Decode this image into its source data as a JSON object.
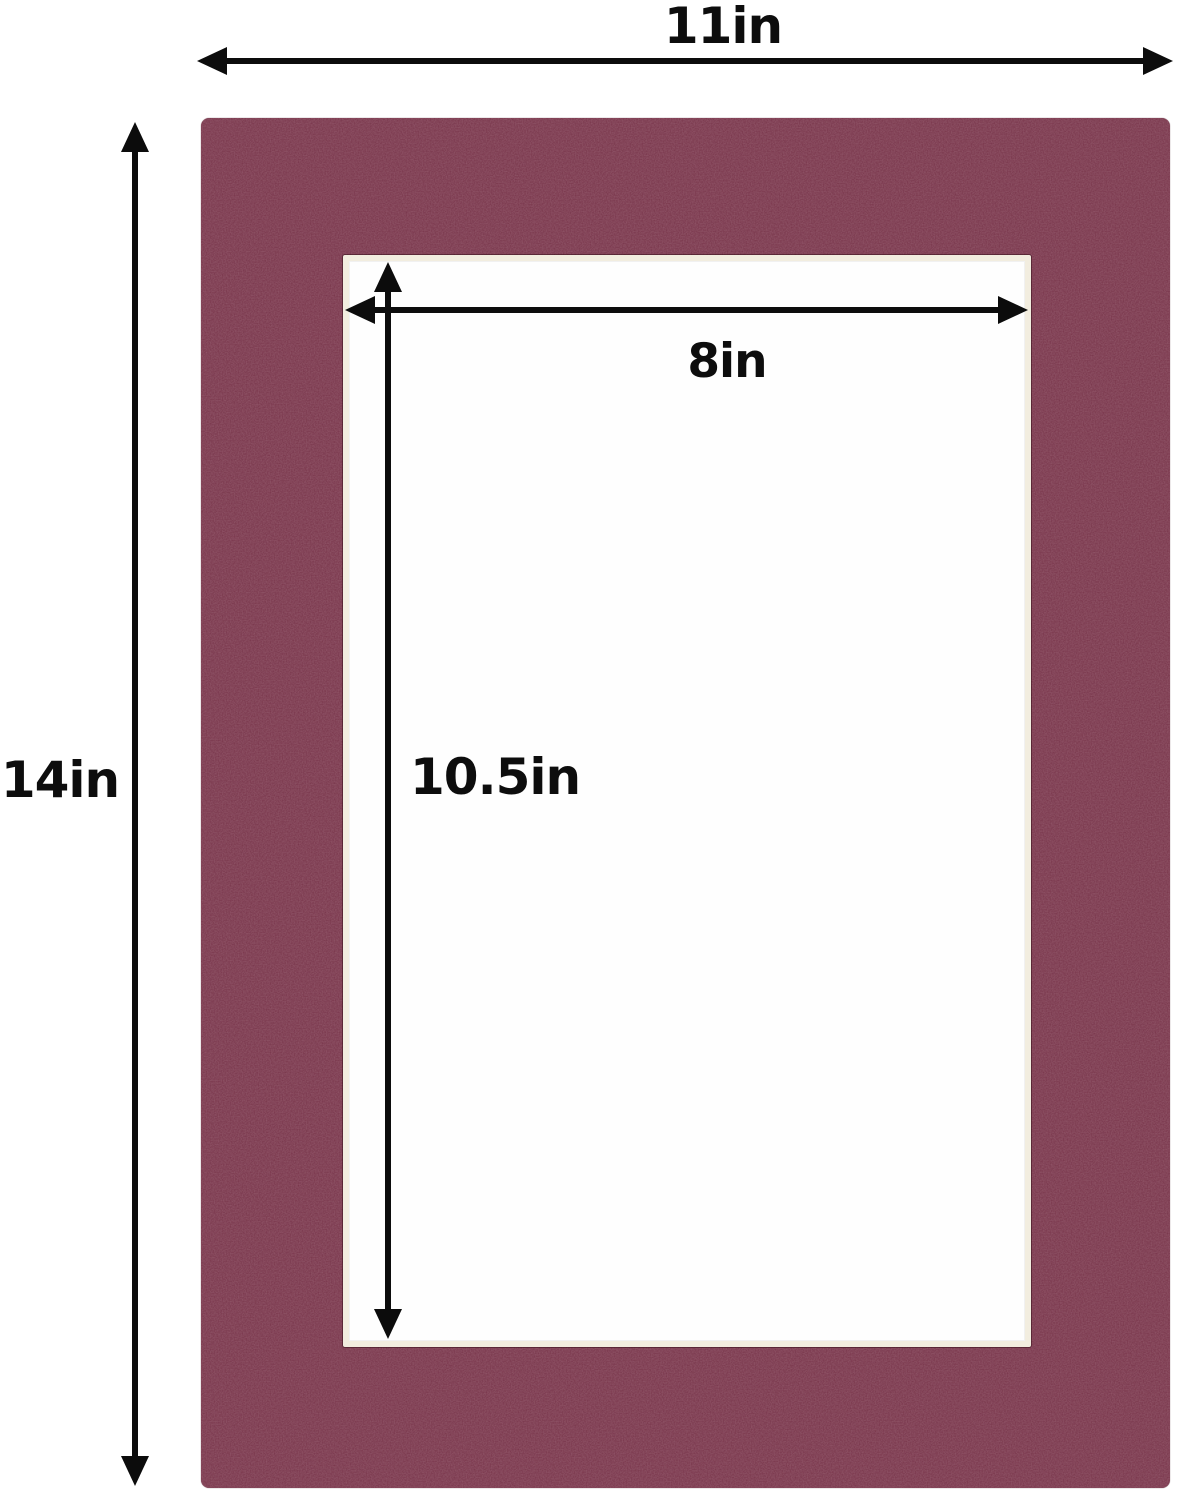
{
  "labels": {
    "outer_width": "11in",
    "outer_height": "14in",
    "opening_width": "8in",
    "opening_height": "10.5in"
  },
  "colors": {
    "mat_board": "#753146",
    "bevel_edge": "#f2eddf",
    "opening_fill": "#fefefe",
    "dimension_lines": "#0c0c0c",
    "background": "#ffffff"
  }
}
